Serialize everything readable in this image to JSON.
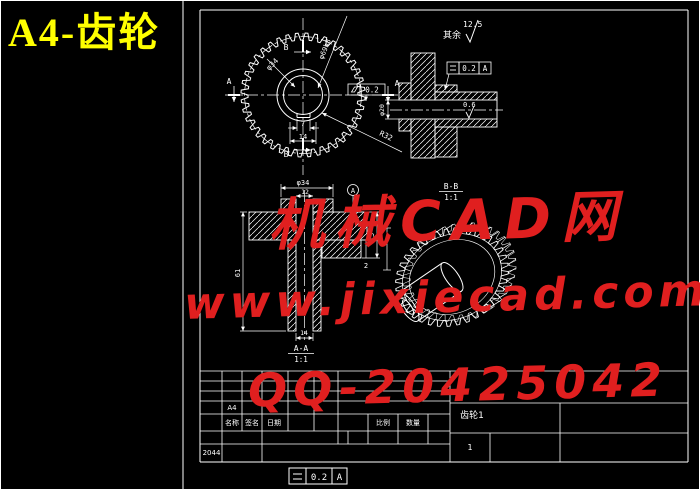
{
  "overlay_title": "A4-齿轮",
  "watermark": {
    "site": "机械CAD网",
    "url": "www.jixiecad.com",
    "qq": "QQ-20425042",
    "color": "#e01f1f"
  },
  "general_note": {
    "others": "其余",
    "roughness": "12.5"
  },
  "front_view": {
    "label_b_top": "B",
    "label_b_bottom": "B",
    "label_a_left": "A",
    "label_a_right": "A",
    "dim_hub_dia": "φ34",
    "dim_tip_dia": "φ69h8",
    "dim_fillet": "R32",
    "dim_keyway_width": "7",
    "dim_keyway_span": "14",
    "fcf_value": "0.2"
  },
  "section_view": {
    "fcf_value": "0.2",
    "fcf_datum": "A",
    "roughness": "0.6",
    "dim_bore": "φ20"
  },
  "aa_section": {
    "title": "A-A",
    "scale": "1:1",
    "dim_hub": "φ34",
    "dim_bore": "12",
    "dim_height": "61",
    "dim_flange": "15",
    "dim_step": "2",
    "dim_keyway": "14",
    "datum_label": "A"
  },
  "bb_view": {
    "title": "B-B",
    "scale": "1:1"
  },
  "bottom_fcf": {
    "value": "0.2",
    "datum": "A"
  },
  "title_block": {
    "sheet_size": "A4",
    "name_label": "名称",
    "sign_label": "签名",
    "date_label": "日期",
    "drawing_no": "2044",
    "scale_label": "比例",
    "qty_label": "数量",
    "part_name": "齿轮1",
    "sheet_count": "1"
  }
}
